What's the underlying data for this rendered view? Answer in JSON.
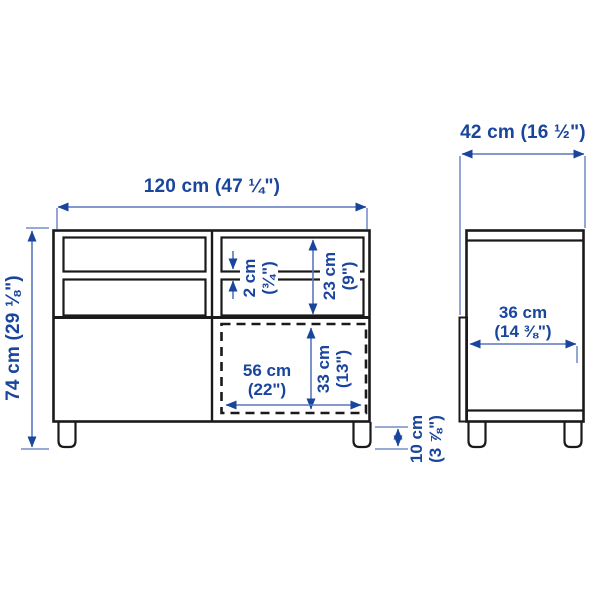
{
  "colors": {
    "background": "#ffffff",
    "furniture_outline": "#1a1a1a",
    "dimension_line": "#5b76bd",
    "dimension_accent": "#1a459c"
  },
  "front_view": {
    "width_label": "120 cm (47 ¼\")",
    "height_label": "74 cm (29 ⅛\")",
    "shelf_thickness": {
      "line1": "2 cm",
      "line2": "(¾\")"
    },
    "compartment_height": {
      "line1": "23 cm",
      "line2": "(9\")"
    },
    "opening_width": {
      "line1": "56 cm",
      "line2": "(22\")"
    },
    "opening_height": {
      "line1": "33 cm",
      "line2": "(13\")"
    },
    "leg_height": {
      "line1": "10 cm",
      "line2": "(3 ⅞\")"
    }
  },
  "side_view": {
    "depth_label": "42 cm (16 ½\")",
    "inner_depth": {
      "line1": "36 cm",
      "line2": "(14 ⅜\")"
    }
  }
}
